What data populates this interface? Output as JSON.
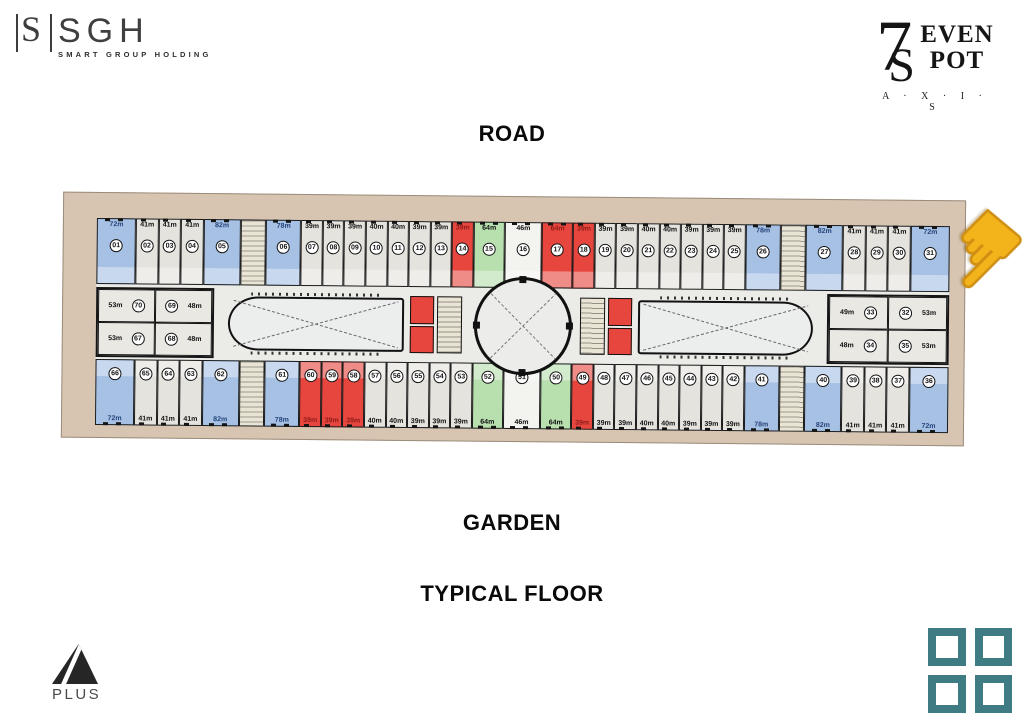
{
  "header": {
    "sgh": {
      "monogram": "S",
      "name": "SGH",
      "tagline": "SMART GROUP HOLDING"
    },
    "sevenspot": {
      "seven": "7",
      "s": "S",
      "even": "EVEN",
      "pot": "POT",
      "axis": "A · X · I · S"
    }
  },
  "labels": {
    "road": "ROAD",
    "garden": "GARDEN",
    "typical_floor": "TYPICAL FLOOR"
  },
  "footer": {
    "aplus_text": "PLUS"
  },
  "icons": {
    "hand_cursor": "☛"
  },
  "colors": {
    "frame_beige": "#d8c5b1",
    "floor_gray": "#ebece8",
    "unit_gray": "#e4e3de",
    "unit_blue": "#a6c1e4",
    "unit_red": "#e7463e",
    "unit_green": "#b8dfae",
    "teal_squares": "#3f7b82",
    "cursor_yellow": "#f2b31b"
  },
  "plan": {
    "rows": {
      "top": [
        {
          "num": "01",
          "size": "72m",
          "color": "blue",
          "w": 1.9
        },
        {
          "num": "02",
          "size": "41m",
          "color": "gray",
          "w": 1.05
        },
        {
          "num": "03",
          "size": "41m",
          "color": "gray",
          "w": 1.05
        },
        {
          "num": "04",
          "size": "41m",
          "color": "gray",
          "w": 1.05
        },
        {
          "num": "05",
          "size": "82m",
          "color": "blue",
          "w": 1.8
        },
        {
          "type": "stair",
          "w": 1.2
        },
        {
          "num": "06",
          "size": "78m",
          "color": "blue",
          "w": 1.7
        },
        {
          "num": "07",
          "size": "39m",
          "color": "gray",
          "w": 1
        },
        {
          "num": "08",
          "size": "39m",
          "color": "gray",
          "w": 1
        },
        {
          "num": "09",
          "size": "39m",
          "color": "gray",
          "w": 1
        },
        {
          "num": "10",
          "size": "40m",
          "color": "gray",
          "w": 1
        },
        {
          "num": "11",
          "size": "40m",
          "color": "gray",
          "w": 1
        },
        {
          "num": "12",
          "size": "39m",
          "color": "gray",
          "w": 1
        },
        {
          "num": "13",
          "size": "39m",
          "color": "gray",
          "w": 1
        },
        {
          "num": "14",
          "size": "39m",
          "color": "red",
          "w": 1
        },
        {
          "num": "15",
          "size": "64m",
          "color": "green",
          "w": 1.5
        },
        {
          "num": "16",
          "size": "46m",
          "color": "white",
          "w": 1.8
        },
        {
          "num": "17",
          "size": "64m",
          "color": "red",
          "w": 1.5
        },
        {
          "num": "18",
          "size": "39m",
          "color": "red",
          "w": 1
        },
        {
          "num": "19",
          "size": "39m",
          "color": "gray",
          "w": 1
        },
        {
          "num": "20",
          "size": "39m",
          "color": "gray",
          "w": 1
        },
        {
          "num": "21",
          "size": "40m",
          "color": "gray",
          "w": 1
        },
        {
          "num": "22",
          "size": "40m",
          "color": "gray",
          "w": 1
        },
        {
          "num": "23",
          "size": "39m",
          "color": "gray",
          "w": 1
        },
        {
          "num": "24",
          "size": "39m",
          "color": "gray",
          "w": 1
        },
        {
          "num": "25",
          "size": "39m",
          "color": "gray",
          "w": 1
        },
        {
          "num": "26",
          "size": "78m",
          "color": "blue",
          "w": 1.7
        },
        {
          "type": "stair",
          "w": 1.2
        },
        {
          "num": "27",
          "size": "82m",
          "color": "blue",
          "w": 1.8
        },
        {
          "num": "28",
          "size": "41m",
          "color": "gray",
          "w": 1.05
        },
        {
          "num": "29",
          "size": "41m",
          "color": "gray",
          "w": 1.05
        },
        {
          "num": "30",
          "size": "41m",
          "color": "gray",
          "w": 1.05
        },
        {
          "num": "31",
          "size": "72m",
          "color": "blue",
          "w": 1.9
        }
      ],
      "bottom": [
        {
          "num": "66",
          "size": "72m",
          "color": "blue",
          "w": 1.9
        },
        {
          "num": "65",
          "size": "41m",
          "color": "gray",
          "w": 1.05
        },
        {
          "num": "64",
          "size": "41m",
          "color": "gray",
          "w": 1.05
        },
        {
          "num": "63",
          "size": "41m",
          "color": "gray",
          "w": 1.05
        },
        {
          "num": "62",
          "size": "82m",
          "color": "blue",
          "w": 1.8
        },
        {
          "type": "stair",
          "w": 1.2
        },
        {
          "num": "61",
          "size": "78m",
          "color": "blue",
          "w": 1.7
        },
        {
          "num": "60",
          "size": "39m",
          "color": "red",
          "w": 1
        },
        {
          "num": "59",
          "size": "39m",
          "color": "red",
          "w": 1
        },
        {
          "num": "58",
          "size": "39m",
          "color": "red",
          "w": 1
        },
        {
          "num": "57",
          "size": "40m",
          "color": "gray",
          "w": 1
        },
        {
          "num": "56",
          "size": "40m",
          "color": "gray",
          "w": 1
        },
        {
          "num": "55",
          "size": "39m",
          "color": "gray",
          "w": 1
        },
        {
          "num": "54",
          "size": "39m",
          "color": "gray",
          "w": 1
        },
        {
          "num": "53",
          "size": "39m",
          "color": "gray",
          "w": 1
        },
        {
          "num": "52",
          "size": "64m",
          "color": "green",
          "w": 1.5
        },
        {
          "num": "51",
          "size": "46m",
          "color": "white",
          "w": 1.8
        },
        {
          "num": "50",
          "size": "64m",
          "color": "green",
          "w": 1.5
        },
        {
          "num": "49",
          "size": "39m",
          "color": "red",
          "w": 1
        },
        {
          "num": "48",
          "size": "39m",
          "color": "gray",
          "w": 1
        },
        {
          "num": "47",
          "size": "39m",
          "color": "gray",
          "w": 1
        },
        {
          "num": "46",
          "size": "40m",
          "color": "gray",
          "w": 1
        },
        {
          "num": "45",
          "size": "40m",
          "color": "gray",
          "w": 1
        },
        {
          "num": "44",
          "size": "39m",
          "color": "gray",
          "w": 1
        },
        {
          "num": "43",
          "size": "39m",
          "color": "gray",
          "w": 1
        },
        {
          "num": "42",
          "size": "39m",
          "color": "gray",
          "w": 1
        },
        {
          "num": "41",
          "size": "78m",
          "color": "blue",
          "w": 1.7
        },
        {
          "type": "stair",
          "w": 1.2
        },
        {
          "num": "40",
          "size": "82m",
          "color": "blue",
          "w": 1.8
        },
        {
          "num": "39",
          "size": "41m",
          "color": "gray",
          "w": 1.05
        },
        {
          "num": "38",
          "size": "41m",
          "color": "gray",
          "w": 1.05
        },
        {
          "num": "37",
          "size": "41m",
          "color": "gray",
          "w": 1.05
        },
        {
          "num": "36",
          "size": "72m",
          "color": "blue",
          "w": 1.9
        }
      ]
    },
    "mid_left": [
      {
        "num": "70",
        "size": "53m",
        "side": "left"
      },
      {
        "num": "69",
        "size": "48m",
        "side": "right"
      },
      {
        "num": "67",
        "size": "53m",
        "side": "left"
      },
      {
        "num": "68",
        "size": "48m",
        "side": "right"
      }
    ],
    "mid_right": [
      {
        "num": "33",
        "size": "49m",
        "side": "left"
      },
      {
        "num": "32",
        "size": "53m",
        "side": "right"
      },
      {
        "num": "34",
        "size": "48m",
        "side": "left"
      },
      {
        "num": "35",
        "size": "53m",
        "side": "right"
      }
    ]
  }
}
